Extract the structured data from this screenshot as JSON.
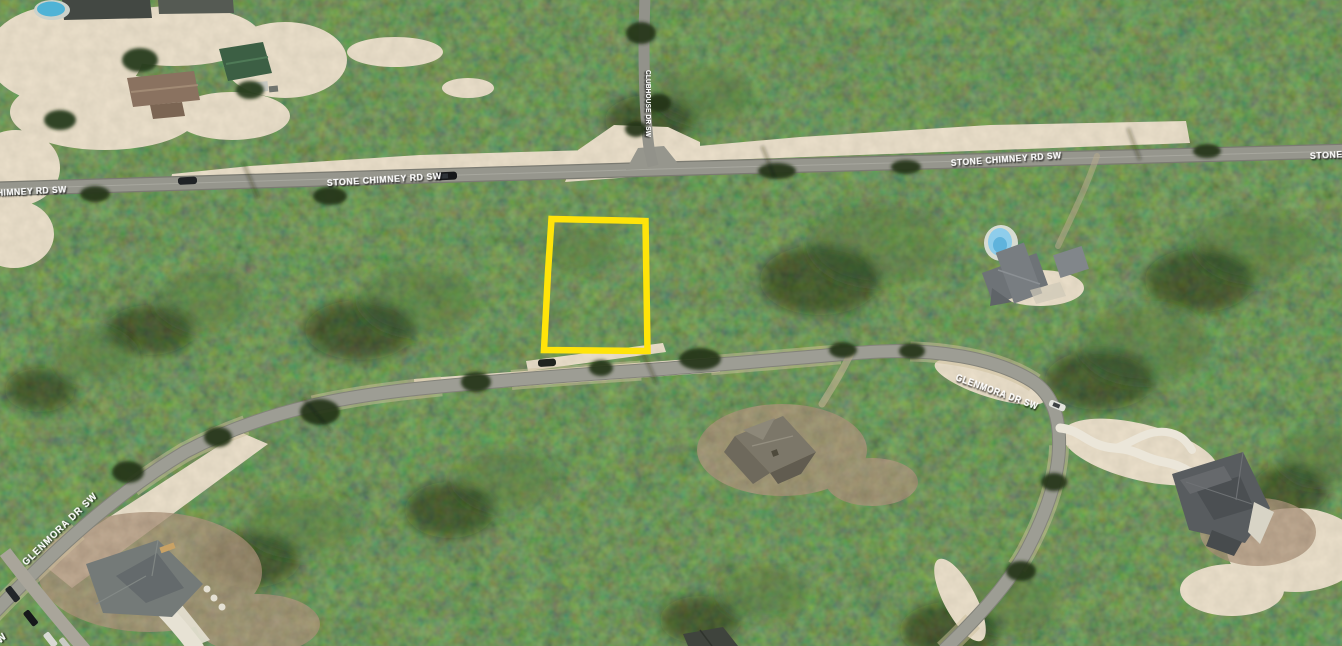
{
  "map": {
    "street_labels": [
      {
        "id": "stone-chimney-left-partial",
        "text": "HIMNEY RD SW"
      },
      {
        "id": "stone-chimney-west",
        "text": "STONE CHIMNEY RD SW"
      },
      {
        "id": "stone-chimney-east",
        "text": "STONE CHIMNEY RD SW"
      },
      {
        "id": "stone-chimney-right-partial",
        "text": "STONE"
      },
      {
        "id": "clubhouse",
        "text": "CLUBHOUSE DR SW"
      },
      {
        "id": "glenmora-east",
        "text": "GLENMORA DR SW"
      },
      {
        "id": "glenmora-west",
        "text": "GLENMORA DR SW"
      },
      {
        "id": "bottom-left-partial",
        "text": "W"
      }
    ],
    "parcel": {
      "outline_color": "#ffe40a"
    },
    "colors": {
      "forest": "#2a3a22",
      "road": "#96968d",
      "sand": "#cfc2a0",
      "dirt": "#5b4531",
      "driveway": "#e9e4d7",
      "pool": "#5fb9d8",
      "label_text": "#ffffff"
    }
  }
}
